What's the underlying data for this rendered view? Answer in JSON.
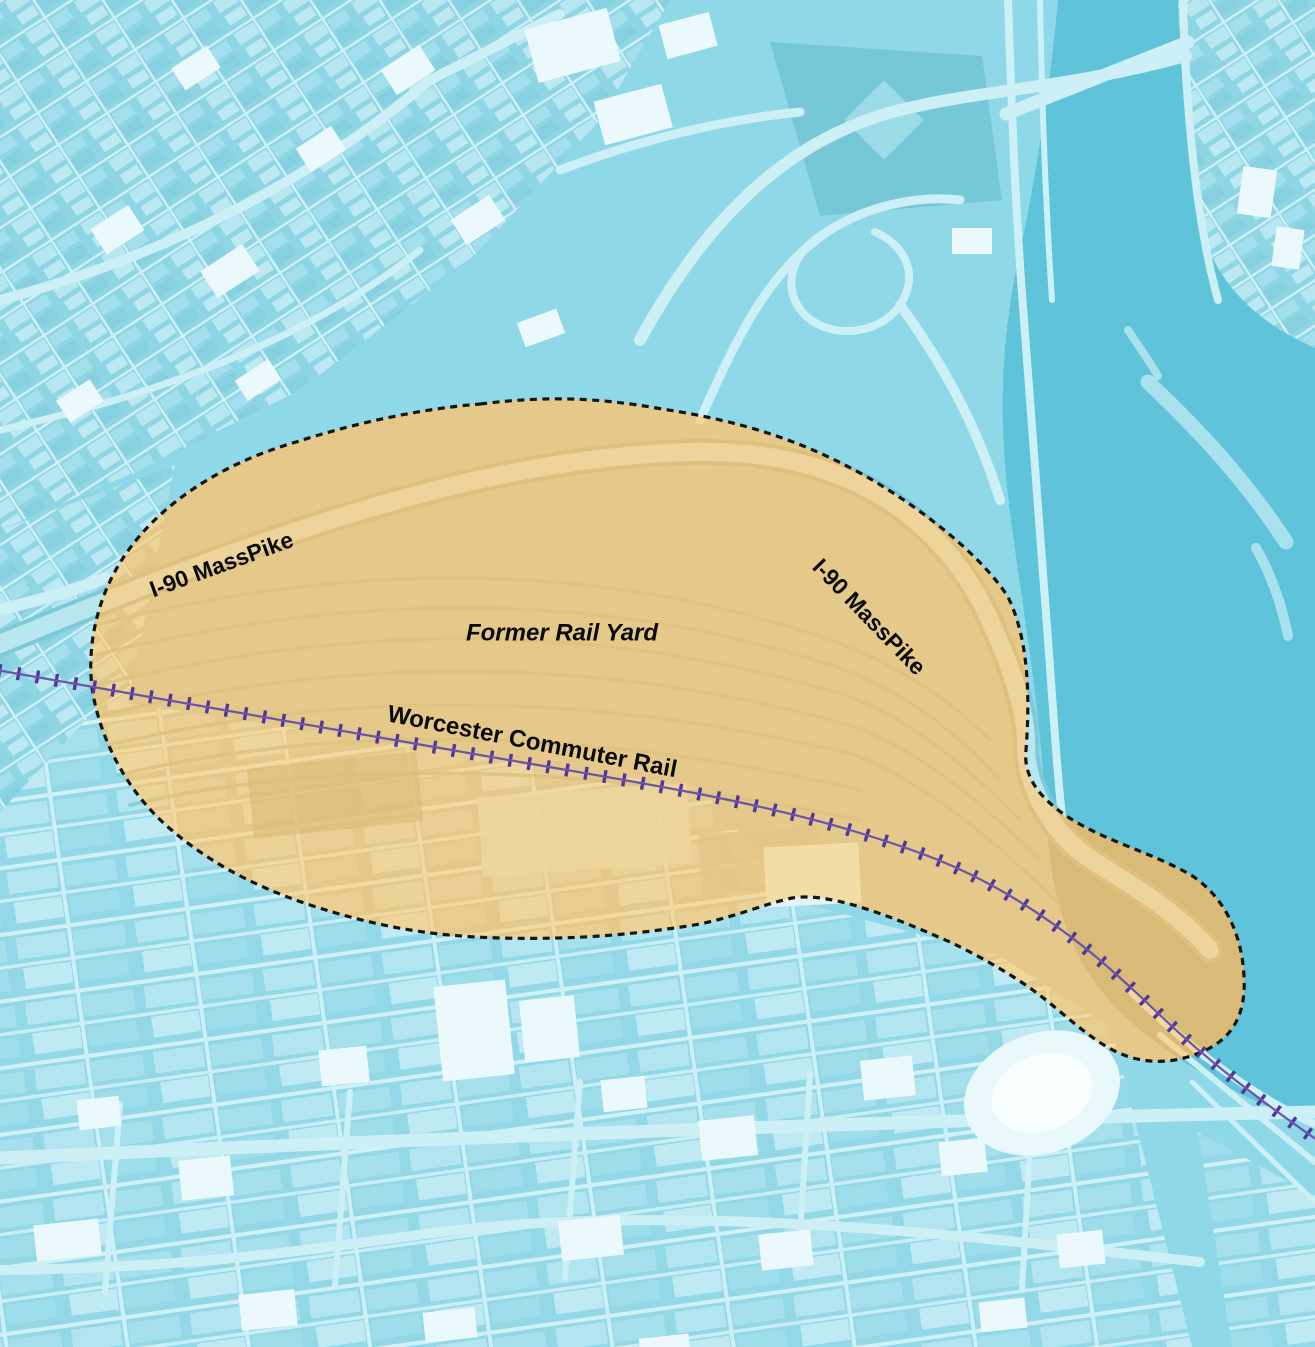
{
  "map": {
    "labels": {
      "masspike_west": "I-90 MassPike",
      "masspike_east": "I-90 MassPike",
      "former_rail_yard": "Former Rail Yard",
      "commuter_rail": "Worcester Commuter Rail"
    },
    "colors": {
      "water": "#5fc3da",
      "land_base": "#8ed8e7",
      "boundary_dash": "#151515",
      "rail_line": "#6b53a8",
      "rail_tick": "#52369c",
      "label_text": "#0a0a0a",
      "highlight_tan": "#e4c98b"
    }
  }
}
